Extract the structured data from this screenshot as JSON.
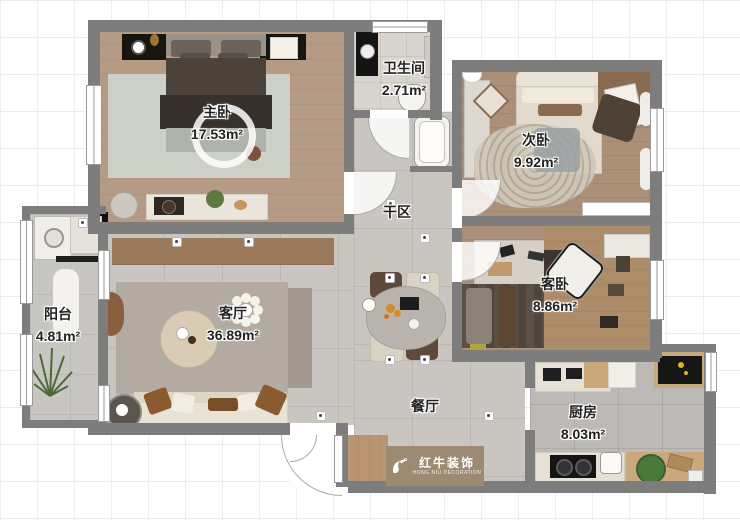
{
  "plan": {
    "rooms": [
      {
        "name": "master-bedroom",
        "label": "主卧",
        "area": "17.53m²"
      },
      {
        "name": "bathroom",
        "label": "卫生间",
        "area": "2.71m²"
      },
      {
        "name": "second-bedroom",
        "label": "次卧",
        "area": "9.92m²"
      },
      {
        "name": "dry-area",
        "label": "干区",
        "area": ""
      },
      {
        "name": "guest-bedroom",
        "label": "客卧",
        "area": "8.86m²"
      },
      {
        "name": "balcony",
        "label": "阳台",
        "area": "4.81m²"
      },
      {
        "name": "living-room",
        "label": "客厅",
        "area": "36.89m²"
      },
      {
        "name": "dining-room",
        "label": "餐厅",
        "area": ""
      },
      {
        "name": "kitchen",
        "label": "厨房",
        "area": "8.03m²"
      }
    ],
    "watermark": {
      "brand_cn": "红牛装饰",
      "brand_en": "HONG NIU DECORATION"
    },
    "colors": {
      "wall": "#7d7d7d",
      "wood_floor": "#b29275",
      "tile_floor": "#c9c5c0",
      "logo_band": "#9d8a73"
    }
  }
}
